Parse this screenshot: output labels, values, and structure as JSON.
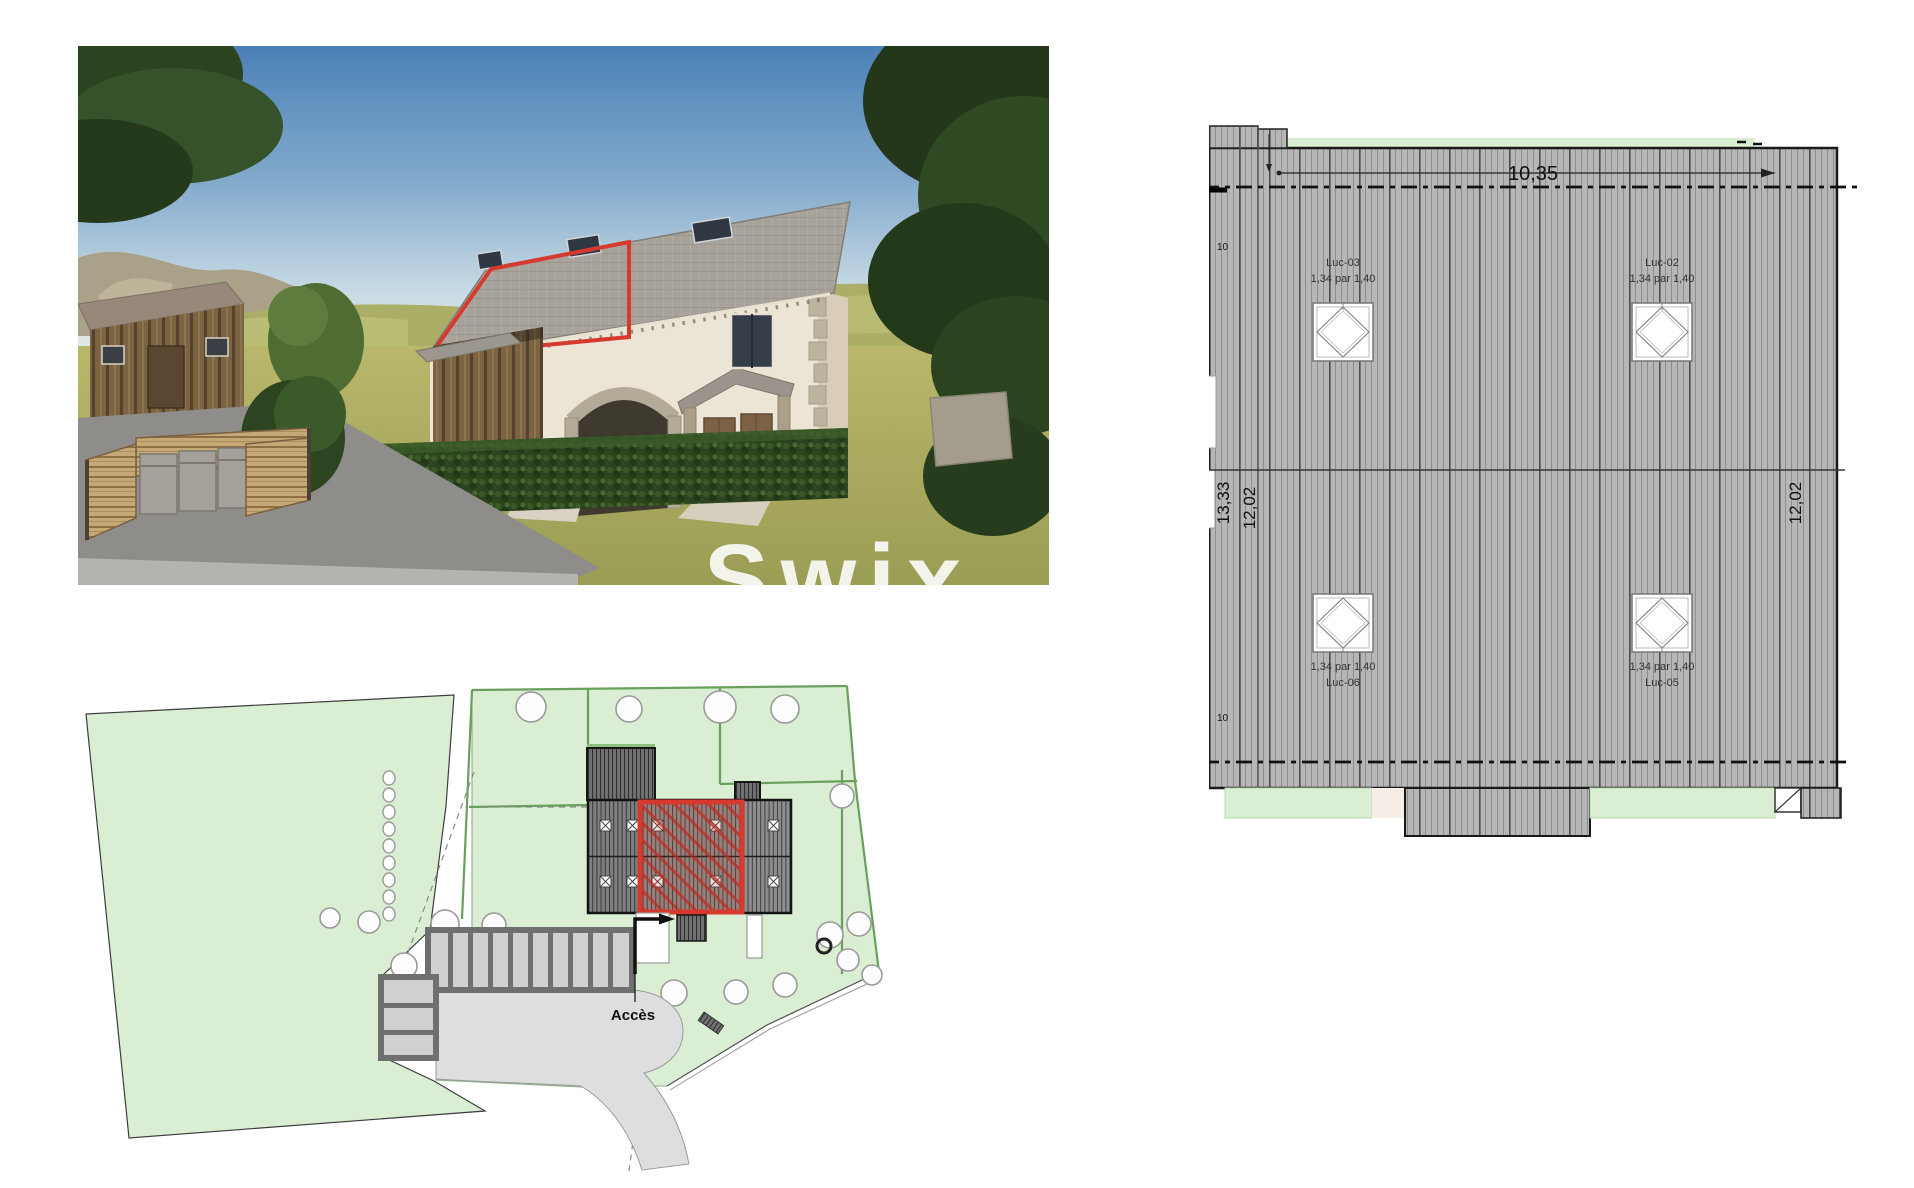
{
  "collage": {
    "photo": {
      "watermark": "Swix"
    },
    "site_plan": {
      "access_label": "Accès"
    },
    "roof_plan": {
      "dim_width_top": "10,35",
      "dim_left_total": "13,33",
      "dim_left_span": "12,02",
      "dim_right_span": "12,02",
      "eave_top_label": "10",
      "eave_bottom_label": "10",
      "skylights": {
        "luc03": {
          "name": "Luc-03",
          "size": "1,34 par 1,40"
        },
        "luc02": {
          "name": "Luc-02",
          "size": "1,34 par 1,40"
        },
        "luc06": {
          "name": "Luc-06",
          "size": "1,34 par 1,40"
        },
        "luc05": {
          "name": "Luc-05",
          "size": "1,34 par 1,40"
        }
      }
    },
    "colors": {
      "highlight_red": "#d63a2e",
      "plan_green_fill": "#daeed3",
      "plan_green_line": "#69a05e",
      "roof_gray": "#b6b6b6"
    }
  }
}
